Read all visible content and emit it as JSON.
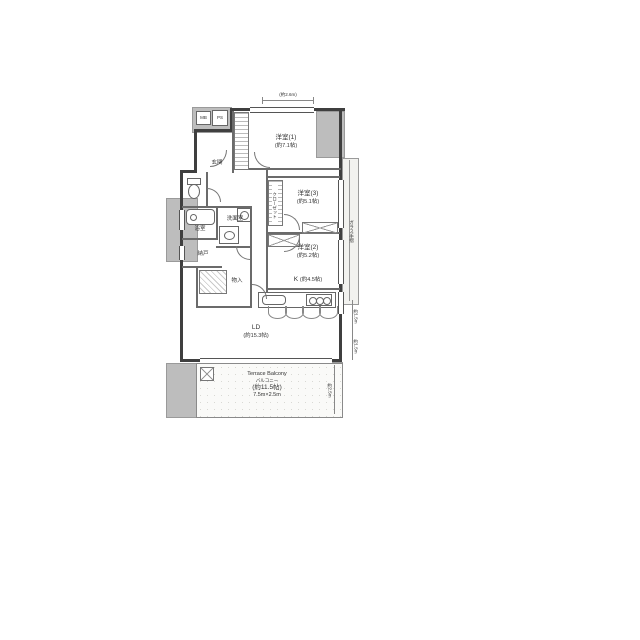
{
  "colors": {
    "wall": "#3f3f3f",
    "common_area": "#bdbdbd",
    "line": "#777777",
    "text": "#333333"
  },
  "rooms": {
    "bed1": {
      "label": "洋室(1)",
      "size": "(約7.1帖)"
    },
    "bed3": {
      "label": "洋室(3)",
      "size": "(約5.1帖)"
    },
    "bed2": {
      "label": "洋室(2)",
      "size": "(約5.2帖)"
    },
    "kitchen": {
      "label": "K",
      "size": "(約4.5帖)"
    },
    "living": {
      "label": "LD",
      "size": "(約15.3帖)"
    },
    "bath": {
      "label": "浴室"
    },
    "powder": {
      "label": "洗面室"
    },
    "storage": {
      "label": "納戸"
    },
    "closet_room": {
      "label": "物入"
    },
    "entrance": {
      "label": "玄関"
    },
    "closet": {
      "label": "クローゼット"
    }
  },
  "balcony": {
    "title": "Terrace Balcony",
    "subtitle": "バルコニー",
    "area": "(約11.5帖)",
    "dimensions": "7.5m×2.5m",
    "depth": "約2.5m"
  },
  "annotations": {
    "top_width": "(約2.6m)",
    "right_rail": "ガラス手摺",
    "right_dim_upper": "約1.5m",
    "right_dim_lower": "約1.5m",
    "box1": "MB",
    "box2": "PS"
  }
}
